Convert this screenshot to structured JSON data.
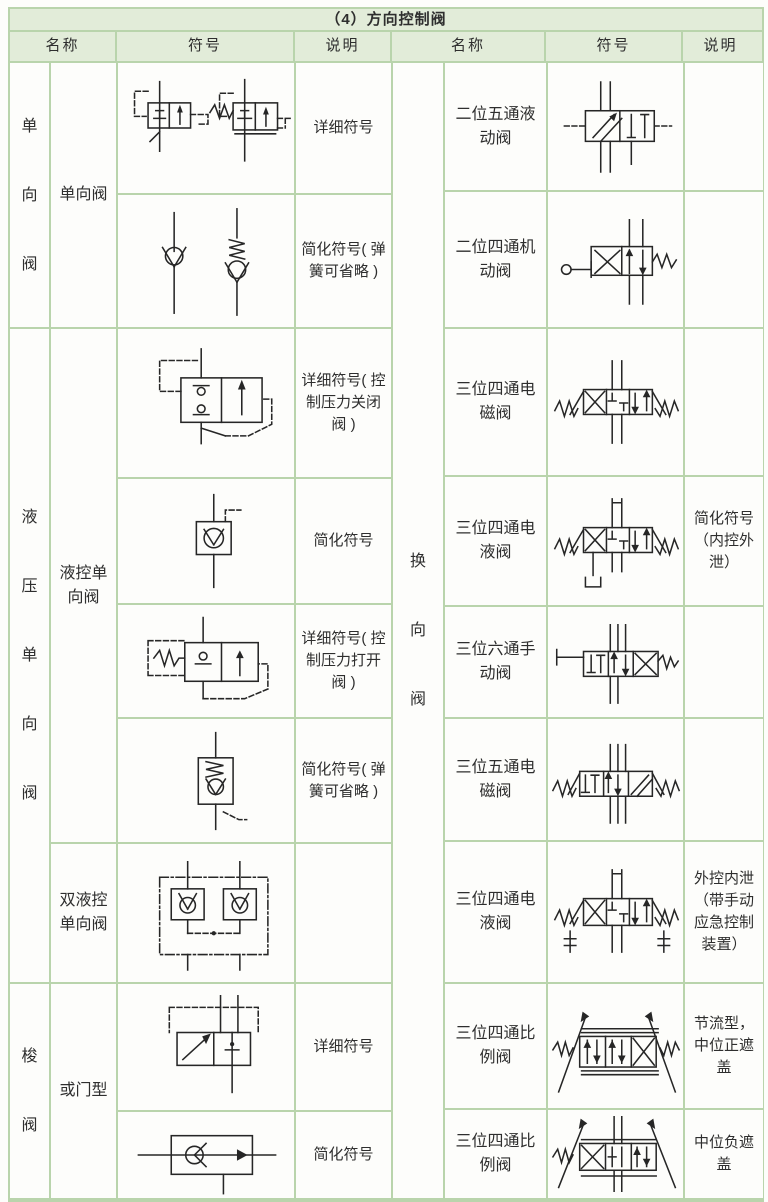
{
  "title": "（4）方向控制阀",
  "header": {
    "name": "名称",
    "symbol": "符号",
    "desc": "说明"
  },
  "colors": {
    "header_bg": "#e2ecd9",
    "border": "#b9d4ac",
    "cell_bg": "#fdfdfb",
    "text": "#2e2e2e",
    "symbol_ink": "#262626"
  },
  "left": {
    "group1": "单向阀",
    "sub1": "单向阀",
    "group2": "液压单向阀",
    "sub2": "液控单向阀",
    "sub3": "双液控单向阀",
    "group3": "梭阀",
    "sub4": "或门型",
    "rows": [
      {
        "symbol": "check-valve-detailed-symbol",
        "desc": "详细符号"
      },
      {
        "symbol": "check-valve-simplified-symbol",
        "desc": "简化符号( 弹簧可省略 )"
      },
      {
        "symbol": "pilot-check-valve-close-detailed-symbol",
        "desc": "详细符号( 控制压力关闭阀 )"
      },
      {
        "symbol": "pilot-check-valve-simplified-symbol",
        "desc": "简化符号"
      },
      {
        "symbol": "pilot-check-valve-open-detailed-symbol",
        "desc": "详细符号( 控制压力打开阀 )"
      },
      {
        "symbol": "pilot-check-valve-spring-simplified-symbol",
        "desc": "简化符号( 弹簧可省略 )"
      },
      {
        "symbol": "double-pilot-check-valve-symbol",
        "desc": ""
      },
      {
        "symbol": "shuttle-valve-detailed-symbol",
        "desc": "详细符号"
      },
      {
        "symbol": "shuttle-valve-simplified-symbol",
        "desc": "简化符号"
      }
    ]
  },
  "right": {
    "group": "换向阀",
    "rows": [
      {
        "name": "二位五通液动阀",
        "symbol": "two-position-five-way-hydraulic-valve-symbol",
        "desc": ""
      },
      {
        "name": "二位四通机动阀",
        "symbol": "two-position-four-way-mechanical-valve-symbol",
        "desc": ""
      },
      {
        "name": "三位四通电磁阀",
        "symbol": "three-position-four-way-solenoid-valve-symbol",
        "desc": ""
      },
      {
        "name": "三位四通电液阀",
        "symbol": "three-position-four-way-electrohydraulic-valve-symbol",
        "desc": "简化符号（内控外泄）"
      },
      {
        "name": "三位六通手动阀",
        "symbol": "three-position-six-way-manual-valve-symbol",
        "desc": ""
      },
      {
        "name": "三位五通电磁阀",
        "symbol": "three-position-five-way-solenoid-valve-symbol",
        "desc": ""
      },
      {
        "name": "三位四通电液阀",
        "symbol": "three-position-four-way-electrohydraulic-valve-external-symbol",
        "desc": "外控内泄（带手动应急控制装置）"
      },
      {
        "name": "三位四通比例阀",
        "symbol": "three-position-four-way-proportional-valve-throttle-symbol",
        "desc": "节流型，中位正遮盖"
      },
      {
        "name": "三位四通比例阀",
        "symbol": "three-position-four-way-proportional-valve-negative-symbol",
        "desc": "中位负遮盖"
      }
    ]
  }
}
